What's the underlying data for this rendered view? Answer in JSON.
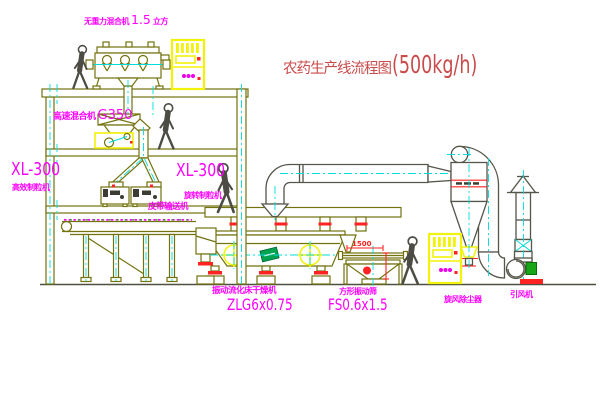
{
  "title": {
    "main": "农药生产线流程图",
    "capacity": "(500kg/h)"
  },
  "labels": {
    "mixer_top_name": "无重力混合机",
    "mixer_top_size": "1.5",
    "mixer_top_unit": "立方",
    "highspeed_name": "高速混合机",
    "highspeed_model": "G350",
    "granulator_left_model": "XL-300",
    "granulator_left_name": "高效制粒机",
    "granulator_right_model": "XL-300",
    "granulator_right_name": "旋转制粒机",
    "belt_conveyor": "皮带输送机",
    "dryer_name": "振动流化床干燥机",
    "dryer_model": "ZLG6x0.75",
    "sieve_name": "方形振动筛",
    "sieve_model": "FS0.6x1.5",
    "cyclone_name": "旋风除尘器",
    "fan_name": "引风机",
    "sieve_dim": "1500"
  },
  "colors": {
    "label_magenta": "#ff00ff",
    "title_red": "#c94b4b",
    "dimension_red": "#ff2222",
    "centerline_cyan": "#00dcdc",
    "cabinet_yellow": "#f2f20a",
    "structure_olive": "#72720e",
    "pipe_gray": "#55554a",
    "motor_green": "#18a518",
    "logo_green": "#00a34f"
  }
}
